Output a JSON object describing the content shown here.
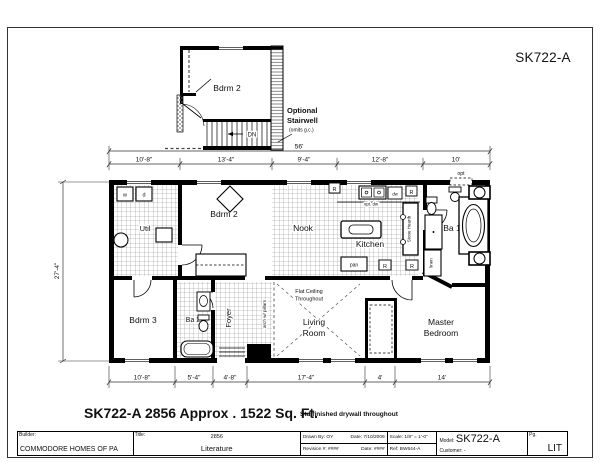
{
  "sheet": {
    "code": "SK722-A"
  },
  "caption": {
    "text": "SK722-A 2856  Approx . 1522 Sq. Ft.",
    "note": "Std finished drywall throughout"
  },
  "inset": {
    "dn": "DN",
    "opt1": "Optional",
    "opt2": "Stairwell",
    "opt3": "(omits g.c.)"
  },
  "dims": {
    "overall": "56'",
    "top": [
      "10'-8\"",
      "13'-4\"",
      "9'-4\"",
      "12'-8\"",
      "10'"
    ],
    "bottom": [
      "10'-8\"",
      "5'-4\"",
      "4'-8\"",
      "17'-4\"",
      "4'",
      "14'"
    ],
    "height": "27'-4\"",
    "opt": "opt"
  },
  "rooms": {
    "util": "Util",
    "bdrm2": "Bdrm 2",
    "nook": "Nook",
    "kitchen": "Kitchen",
    "ba1": "Ba 1",
    "bdrm3": "Bdrm 3",
    "ba2": "Ba 2",
    "foyer": "Foyer",
    "living1": "Living",
    "living2": "Room",
    "master1": "Master",
    "master2": "Bedroom",
    "flat1": "Flat Ceiling",
    "flat2": "Throughout",
    "arch": "arch w/ pillars",
    "hearth": "Stone Hearth",
    "linen": "linen",
    "pan": "pan",
    "optdw": "opt. dw",
    "dw": "dw",
    "w": "w",
    "d": "d",
    "r": "R"
  },
  "titleblock": {
    "builder_label": "Builder:",
    "builder_value": "COMMODORE HOMES OF PA",
    "title_label": "Title:",
    "title_num": "2856",
    "title_value": "Literature",
    "drawn_by": "Drawn By: OY",
    "drawn_date": "Date: 7/10/2009",
    "revision": "Revision #: ####",
    "revision_date": "Date: ####",
    "scale": "Scale: 1/8\" = 1'-0\"",
    "ref": "Ref: BW644-A",
    "model_label": "Model:",
    "model_value": "SK722-A",
    "customer": "Customer: -",
    "pg_label": "Pg.",
    "pg_value": "LIT"
  }
}
